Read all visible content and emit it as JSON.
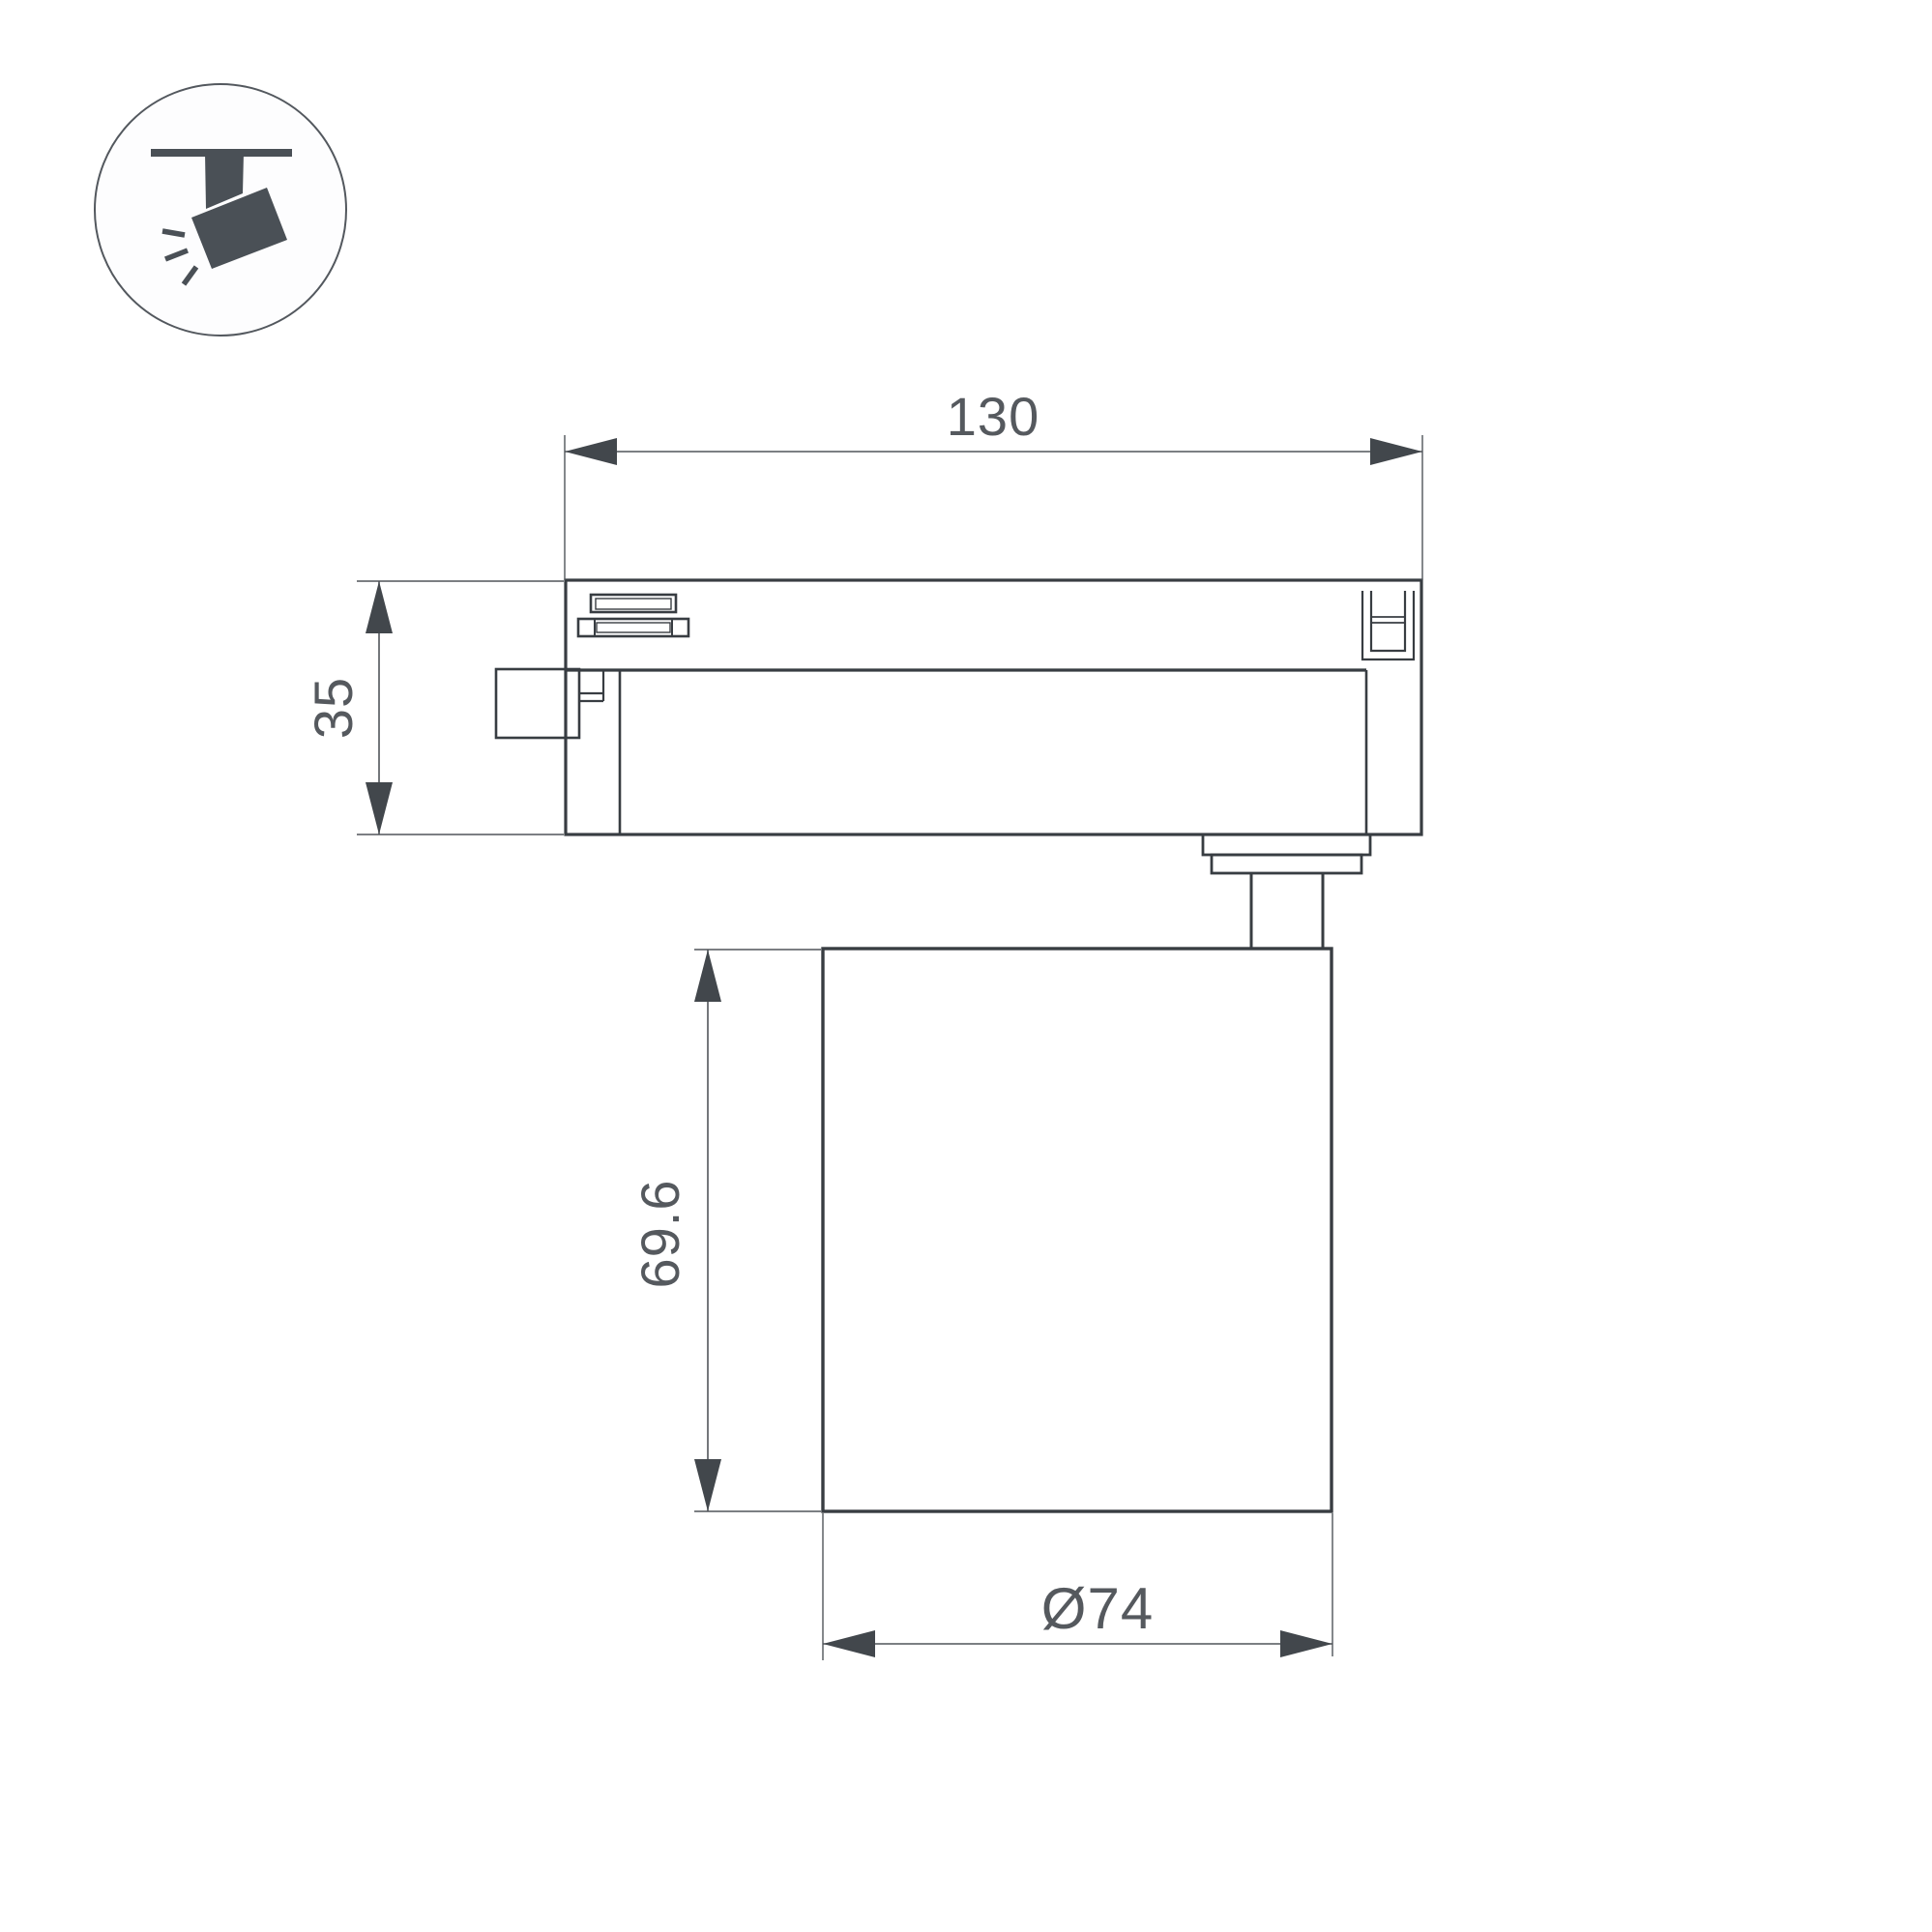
{
  "canvas": {
    "background": "#ffffff"
  },
  "icon": {
    "name": "track-spotlight",
    "fill": "#4a5056",
    "circle_fill": "#fdfdfe",
    "circle_stroke": "#53585e"
  },
  "drawing": {
    "outline_color": "#383d42",
    "dimension_color": "#51555a",
    "arrow_color": "#42474c",
    "text_color": "#55595e",
    "labels": {
      "overall_width": "130",
      "adapter_height": "35",
      "body_height": "69.6",
      "body_diameter": "Ø74"
    }
  }
}
